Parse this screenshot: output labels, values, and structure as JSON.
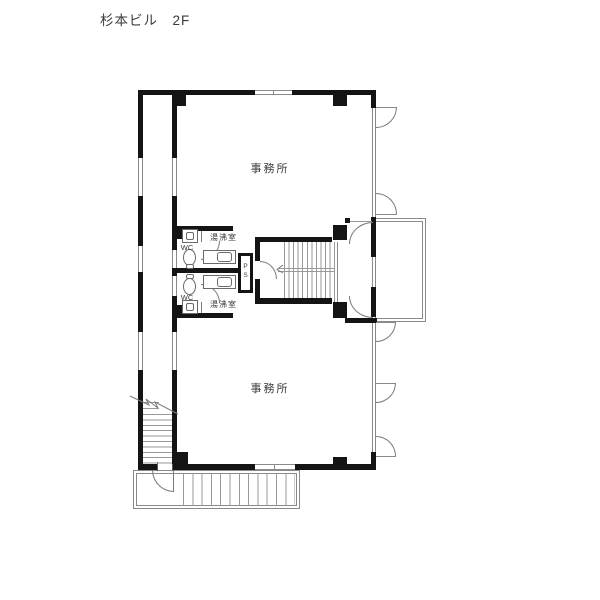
{
  "title": "杉本ビル　2F",
  "floor_plan": {
    "rooms": {
      "office_upper": "事務所",
      "office_lower": "事務所",
      "wc_upper": "WC",
      "wc_lower": "WC",
      "kitchenette_upper": "湯沸室",
      "kitchenette_lower": "湯沸室",
      "pipe_shaft_line1": "P",
      "pipe_shaft_line2": "S"
    },
    "colors": {
      "wall": "#141414",
      "thin_line": "#8a8a8a",
      "text": "#3a3a3a",
      "background": "#ffffff"
    }
  }
}
